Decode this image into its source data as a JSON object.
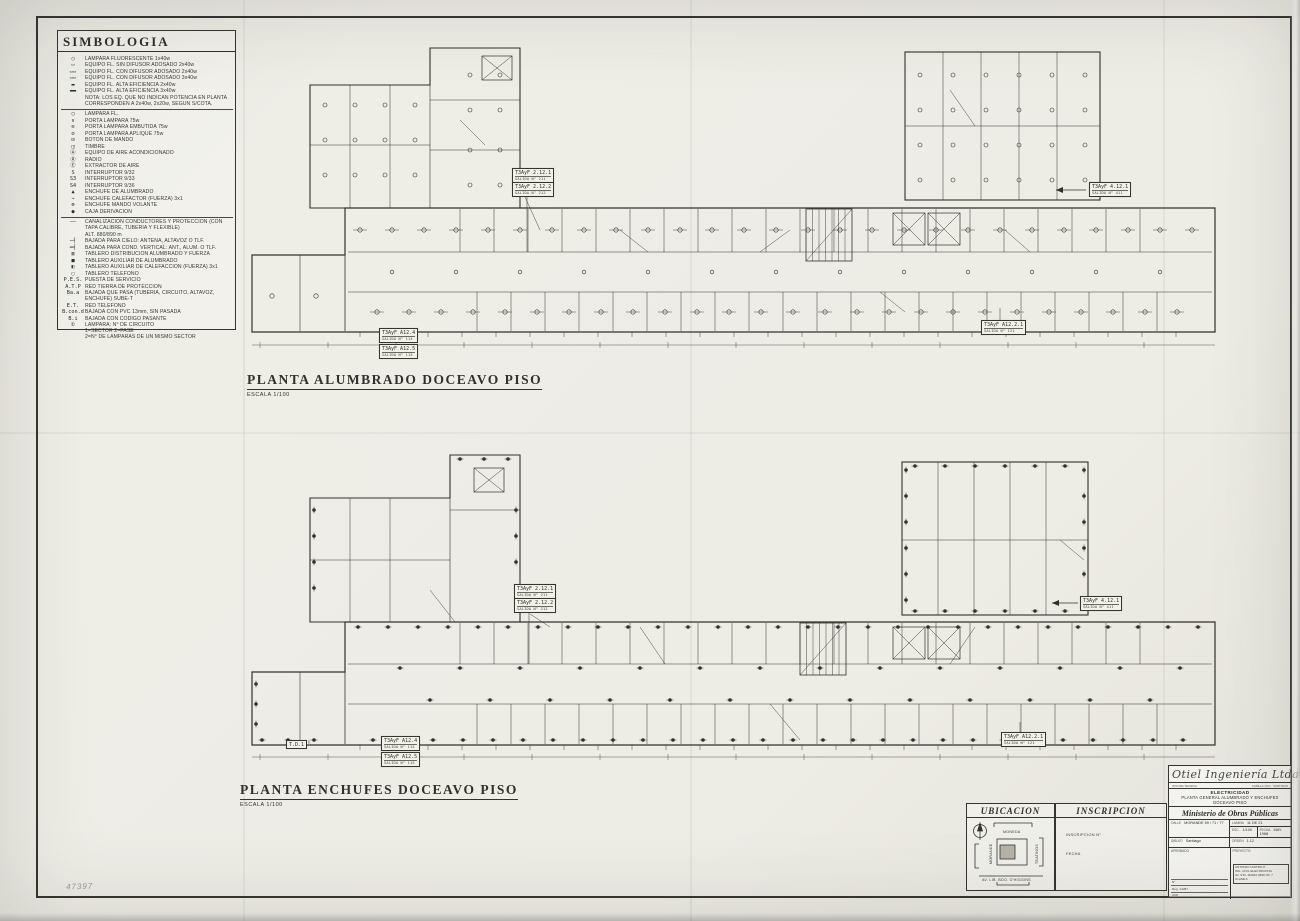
{
  "sheet": {
    "paper_color": "#edece5",
    "ink_color": "#32312c",
    "shade_color": "#b5b3aa",
    "pencil_mark": "47397"
  },
  "legend": {
    "title": "SIMBOLOGIA",
    "sections": [
      {
        "rows": [
          {
            "sym": "◯",
            "label": "LAMPARA FLUORESCENTE 1x40w"
          },
          {
            "sym": "▭",
            "label": "EQUIPO FL. SIN DIFUSOR ADOSADO 2x40w"
          },
          {
            "sym": "▭▭",
            "label": "EQUIPO FL. CON DIFUSOR ADOSADO 2x40w"
          },
          {
            "sym": "▭▭",
            "label": "EQUIPO FL. CON DIFUSOR ADOSADO 3x40w"
          },
          {
            "sym": "▬",
            "label": "EQUIPO FL. ALTA EFICIENCIA 2x40w"
          },
          {
            "sym": "▬▬",
            "label": "EQUIPO FL. ALTA EFICIENCIA 3x40w"
          },
          {
            "sym": "",
            "label": "NOTA: LOS EQ. QUE NO INDICAN POTENCIA EN PLANTA CORRESPONDEN A 2x40w, 2x20w, SEGUN S/COTA."
          }
        ]
      },
      {
        "rows": [
          {
            "sym": "◯",
            "label": "LAMPARA FL."
          },
          {
            "sym": "∨",
            "label": "PORTA LAMPARA 75w"
          },
          {
            "sym": "⊖",
            "label": "PORTA LAMPARA EMBUTIDA 75w"
          },
          {
            "sym": "⊘",
            "label": "PORTA LAMPARA APLIQUE 75w"
          },
          {
            "sym": "⊡",
            "label": "BOTON DE MANDO"
          },
          {
            "sym": "◫",
            "label": "TIMBRE"
          },
          {
            "sym": "Ⓐ",
            "label": "EQUIPO DE AIRE ACONDICIONADO"
          },
          {
            "sym": "Ⓡ",
            "label": "RADIO"
          },
          {
            "sym": "Ⓔ",
            "label": "EXTRACTOR DE AIRE"
          },
          {
            "sym": "S",
            "label": "INTERRUPTOR 9/32"
          },
          {
            "sym": "S3",
            "label": "INTERRUPTOR 9/33"
          },
          {
            "sym": "S4",
            "label": "INTERRUPTOR 9/36"
          },
          {
            "sym": "▲",
            "label": "ENCHUFE DE ALUMBRADO"
          },
          {
            "sym": "⌁",
            "label": "ENCHUFE CALEFACTOR (FUERZA) 3x1"
          },
          {
            "sym": "⊗",
            "label": "ENCHUFE MANDO VOLANTE"
          },
          {
            "sym": "●",
            "label": "CAJA DERIVACION"
          }
        ]
      },
      {
        "rows": [
          {
            "sym": "——",
            "label": "CANALIZACION CONDUCTORES Y PROTECCION (CON TAPA CALIBRE, TUBERIA Y FLEXIBLE)"
          },
          {
            "sym": "",
            "label": "ALT. 880/890 m"
          },
          {
            "sym": "─┤",
            "label": "BAJADA PARA CIELO: ANTENA, ALTAVOZ O TLF."
          },
          {
            "sym": "═╡",
            "label": "BAJADA PARA COND. VERTICAL: ANT., ALUM. O TLF."
          },
          {
            "sym": "▥",
            "label": "TABLERO DISTRIBUCION ALUMBRADO Y FUERZA"
          },
          {
            "sym": "■",
            "label": "TABLERO AUXILIAR DE ALUMBRADO"
          },
          {
            "sym": "◧",
            "label": "TABLERO AUXILIAR DE CALEFACCION (FUERZA) 3x1"
          },
          {
            "sym": "▢",
            "label": "TABLERO TELEFONO"
          },
          {
            "sym": "P.E.S.",
            "label": "PUESTA DE SERVICIO"
          },
          {
            "sym": "A.T.P",
            "label": "RED TIERRA DE PROTECCION"
          },
          {
            "sym": "Ba.a",
            "label": "BAJADA QUE PASA (TUBERIA, CIRCUITO, ALTAVOZ, ENCHUFE) SUBE-T"
          },
          {
            "sym": "E.T.",
            "label": "RED TELEFONO"
          },
          {
            "sym": "B.con.d",
            "label": "BAJADA CON PVC 13mm, SIN PASADA"
          },
          {
            "sym": "B.i",
            "label": "BAJADA CON CODIGO PASANTE"
          },
          {
            "sym": "①",
            "label": "LAMPARA: N° DE CIRCUITO\n1=SECTOR  2=FASE\n2=N° DE LAMPARAS DE UN MISMO SECTOR"
          }
        ]
      }
    ]
  },
  "plans": [
    {
      "title": "PLANTA ALUMBRADO DOCEAVO PISO",
      "scale": "ESCALA 1/100",
      "tags": [
        {
          "id": "t1a",
          "text": "T3AyF 2.12.1",
          "sub": "SALIDA N° 211"
        },
        {
          "id": "t1b",
          "text": "T3AyF 2.12.2",
          "sub": "SALIDA N° 212"
        },
        {
          "id": "t2",
          "text": "T3AyF 4.12.1",
          "sub": "SALIDA N° 411"
        },
        {
          "id": "t3",
          "text": "T3AyF A12.2.1",
          "sub": "SALIDA N° 121"
        },
        {
          "id": "t4a",
          "text": "T3AyF A12.4",
          "sub": "SALIDA N° 114"
        },
        {
          "id": "t4b",
          "text": "T3AyF A12.5",
          "sub": "SALIDA N° 115"
        }
      ]
    },
    {
      "title": "PLANTA ENCHUFES DOCEAVO PISO",
      "scale": "ESCALA 1/100",
      "tags": [
        {
          "id": "b1a",
          "text": "T3AyF 2.12.1",
          "sub": "SALIDA N° 211"
        },
        {
          "id": "b1b",
          "text": "T3AyF 2.12.2",
          "sub": "SALIDA N° 212"
        },
        {
          "id": "b2",
          "text": "T3AyF 4.12.1",
          "sub": "SALIDA N° 411"
        },
        {
          "id": "b3",
          "text": "T3AyF A12.2.1",
          "sub": "SALIDA N° 121"
        },
        {
          "id": "btd",
          "text": "T.D.1",
          "sub": ""
        },
        {
          "id": "b4a",
          "text": "T3AyF A12.4",
          "sub": "SALIDA N° 114"
        },
        {
          "id": "b4b",
          "text": "T3AyF A12.5",
          "sub": "SALIDA N° 115"
        }
      ]
    }
  ],
  "ubicacion": {
    "title": "UBICACION",
    "street_top": "MONEDA",
    "street_left": "MORANDE",
    "street_right": "TEATINOS",
    "street_bottom": "AV. LIB. BDO. O'HIGGINS"
  },
  "inscripcion": {
    "title": "INSCRIPCION",
    "field1": "INSCRIPCION  N°",
    "field2": "FECHA"
  },
  "titleblock": {
    "company": "Otiel Ingeniería Ltda.",
    "company_sub_left": "OFICINA TECNICA",
    "company_sub_right": "CASILLA 13-D · SANTIAGO",
    "discipline": "ELECTRICIDAD",
    "drawing_line1": "PLANTA GENERAL ALUMBRADO Y ENCHUFES",
    "drawing_line2": "DOCEAVO PISO",
    "client": "Ministerio de Obras Públicas",
    "calle_label": "CALLE",
    "calle_value": "MORANDE 59 / 71 / 77",
    "lamina_label": "LAMINA",
    "lamina_value": "11 DE 21",
    "esc_label": "ESC.",
    "esc_value": "1/100",
    "fecha_label": "FECHA",
    "fecha_value": "MAY. 1968",
    "dibujo_label": "DIBUJO",
    "dibujo_value": "Santiago",
    "orden_label": "ORDEN",
    "orden_value": "1.12",
    "aprobado_label": "APROBADO",
    "aprobado_lines": [
      "N°",
      "Reg. 14287",
      "ACP"
    ],
    "proyecto_label": "PROYECTO:",
    "proyecto_lines": [
      "ANTONIO CASTRO P.",
      "ING. CIVIL ELECTRICISTA",
      "AV. STA. MARIA 0250 OF. 7",
      "CLASE A"
    ]
  }
}
